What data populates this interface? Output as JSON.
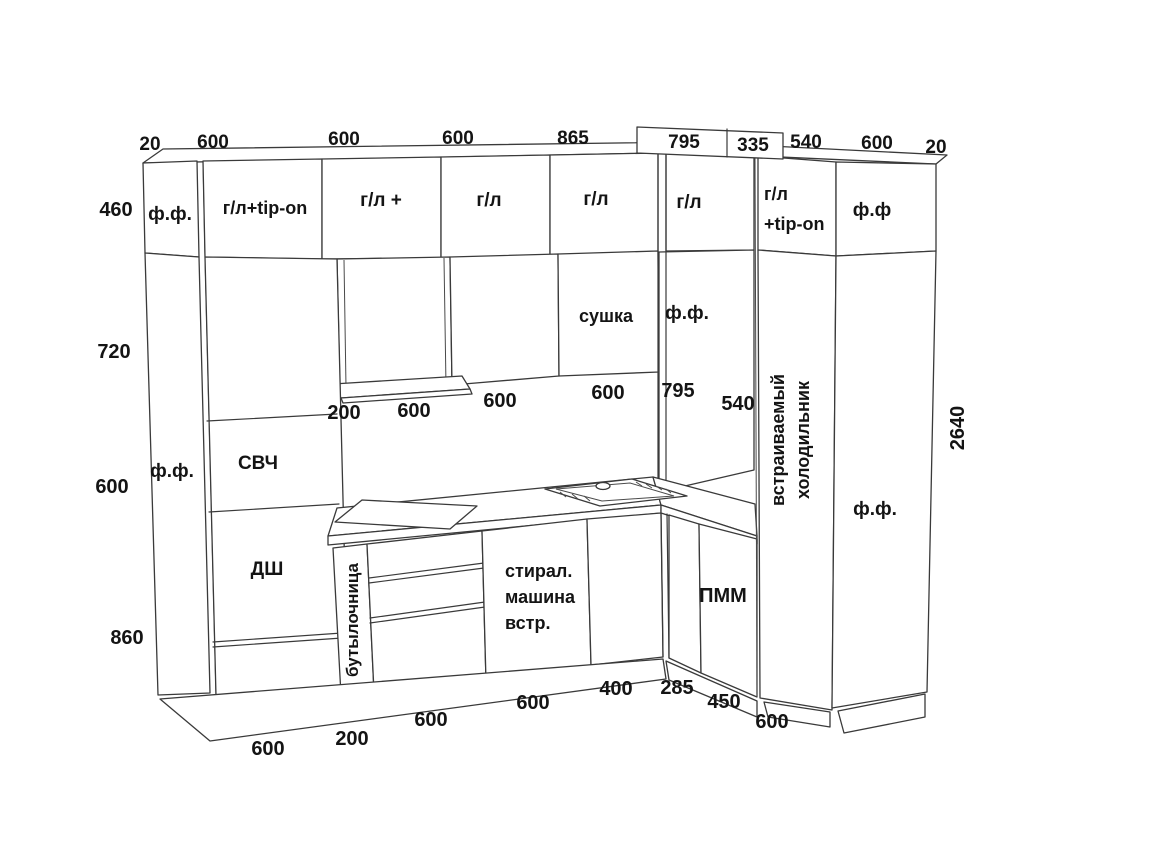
{
  "dims": {
    "top": [
      "20",
      "600",
      "600",
      "600",
      "865"
    ],
    "top_box": [
      "795",
      "335"
    ],
    "top_right": [
      "540",
      "600",
      "20"
    ],
    "left": [
      "460",
      "720",
      "600",
      "860"
    ],
    "right_height": "2640",
    "mid": [
      "200",
      "600",
      "600",
      "600",
      "795",
      "540"
    ],
    "bottom": [
      "600",
      "200",
      "600",
      "600",
      "400",
      "285",
      "450",
      "600"
    ]
  },
  "cabinets": {
    "left_panel": "ф.ф.",
    "upper_row": [
      "ф.ф.",
      "г/л+tip-on",
      "г/л +",
      "г/л",
      "г/л",
      "г/л"
    ],
    "fridge_top_door": {
      "line1": "г/л",
      "line2": "+tip-on"
    },
    "right_top_panel": "ф.ф",
    "second_row": {
      "sushka": "сушка",
      "ff_corner": "ф.ф."
    },
    "tall_unit": {
      "top": "СВЧ",
      "bottom": "ДШ"
    },
    "base": {
      "bottle": "бутылочница",
      "washer": [
        "стирал.",
        "машина",
        "встр."
      ],
      "dishwasher": "ПММ"
    },
    "fridge": {
      "line1": "встраиваемый",
      "line2": "холодильник"
    },
    "right_panel": "ф.ф."
  }
}
